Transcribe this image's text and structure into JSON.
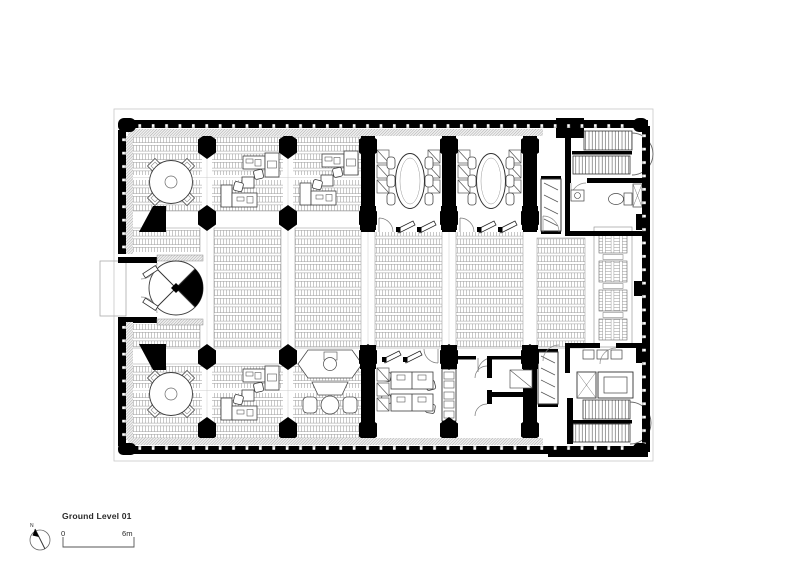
{
  "sheet": {
    "title": "Ground Level 01",
    "north": {
      "label": "N",
      "icon": "north-arrow-icon"
    },
    "scale_bar": {
      "start_label": "0",
      "end_label": "6m"
    }
  },
  "drawing": {
    "type": "architectural-floor-plan",
    "palette": {
      "wall_ink": "#000000",
      "furniture_line": "#3d3d3d",
      "hatch_fine": "#b9b9b9",
      "hatch_edge": "#8f8f8f",
      "grid_line": "#cccccc",
      "paper": "#ffffff"
    }
  }
}
